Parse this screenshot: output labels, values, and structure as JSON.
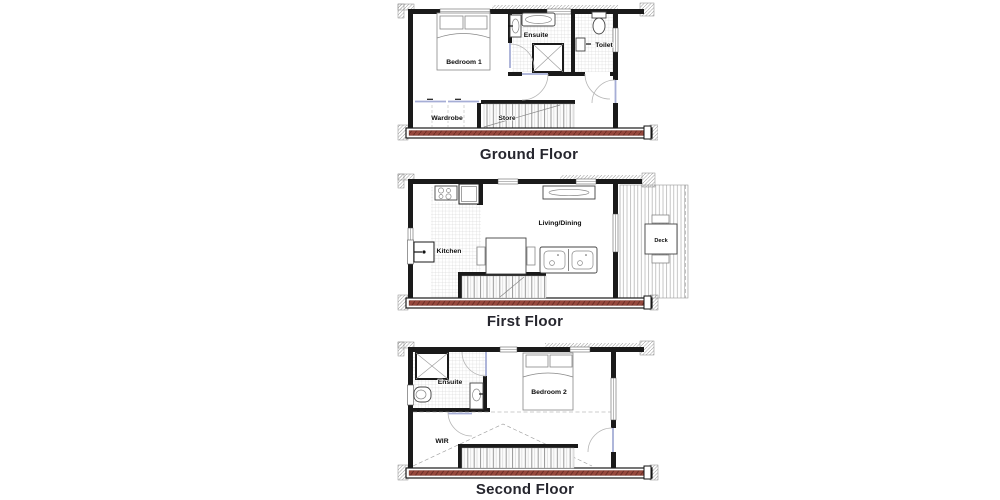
{
  "page": {
    "background": "#ffffff"
  },
  "colors": {
    "wall": "#1a1a1a",
    "plate_band": "#96483d",
    "plate_band_hatch": "#6b2f27",
    "door_leaf": "#a6aed6",
    "swing_arc": "#b5b5b5",
    "tile_line": "#c8c8c8",
    "deck_line": "#adadad",
    "trim_hatch": "#9b9b9b",
    "title_text": "#26262e",
    "label_text": "#0d0d0d"
  },
  "floors": [
    {
      "title": "Ground Floor",
      "rooms": {
        "bedroom1": "Bedroom 1",
        "ensuite": "Ensuite",
        "toilet": "Toilet",
        "wardrobe": "Wardrobe",
        "store": "Store"
      },
      "symbols": [
        "bed",
        "bath",
        "shower",
        "basin",
        "toilet",
        "stairs",
        "sliding-wardrobe-doors"
      ]
    },
    {
      "title": "First Floor",
      "rooms": {
        "kitchen": "Kitchen",
        "living": "Living/Dining",
        "deck": "Deck"
      },
      "symbols": [
        "cooktop",
        "fridge",
        "sink",
        "dining-table",
        "sofa",
        "sideboard",
        "stairs",
        "outdoor-table"
      ]
    },
    {
      "title": "Second Floor",
      "rooms": {
        "ensuite": "Ensuite",
        "bedroom2": "Bedroom 2",
        "wir": "WIR"
      },
      "symbols": [
        "shower",
        "toilet",
        "vanity",
        "bed",
        "stairs"
      ]
    }
  ]
}
